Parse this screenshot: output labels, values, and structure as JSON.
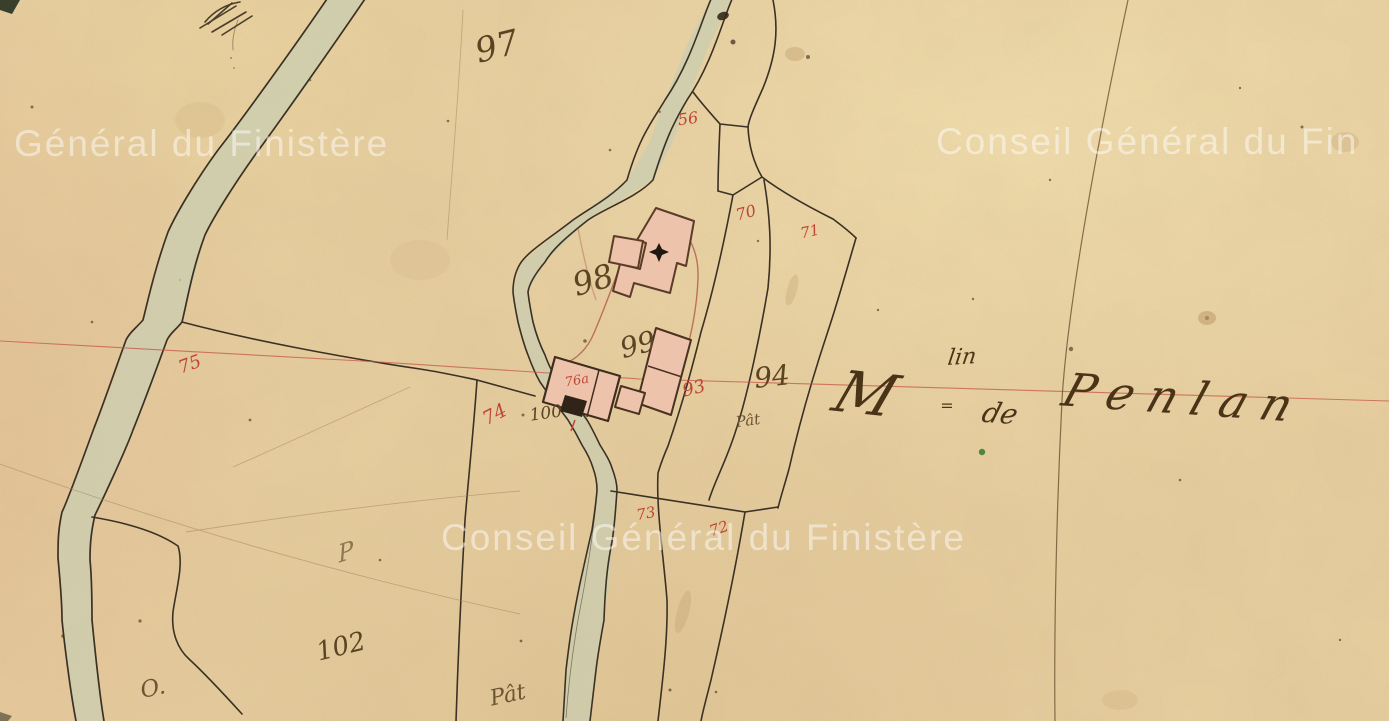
{
  "document_type": "Scanned 19th-century French cadastral map sheet (Finistère archives)",
  "place_name": {
    "abbreviation_initial": "M",
    "abbreviation_superscript": "lin",
    "abbreviation_underscore": "=",
    "connector": "de",
    "name": "Penlan",
    "reads_as": "Moulin de Penlan"
  },
  "watermarks": [
    {
      "text": "Général du Finistère"
    },
    {
      "text": "Conseil Général du Fin"
    },
    {
      "text": "Conseil Général du Finistère"
    }
  ],
  "parcel_numbers_black": [
    {
      "value": "97"
    },
    {
      "value": "98"
    },
    {
      "value": "99"
    },
    {
      "value": "100"
    },
    {
      "value": "102"
    },
    {
      "value": "94"
    }
  ],
  "parcel_numbers_red": [
    {
      "value": "75"
    },
    {
      "value": "74"
    },
    {
      "value": "76a"
    },
    {
      "value": "56"
    },
    {
      "value": "70"
    },
    {
      "value": "71"
    },
    {
      "value": "93"
    },
    {
      "value": "73"
    },
    {
      "value": "72"
    }
  ],
  "handwritten_notes": [
    {
      "text": "Pât"
    },
    {
      "text": "Pât"
    },
    {
      "text": "O."
    },
    {
      "text": "P"
    }
  ],
  "colors": {
    "paper": "#e8cfa0",
    "ink": "#3b3124",
    "red_ink": "#bf4535",
    "survey_red_line": "#c4574a",
    "road_fill": "#c9cdb1",
    "building_fill": "#eec3ab",
    "building_outline": "#5a3c28",
    "watermark": "rgba(255,255,255,0.48)",
    "toponym_ink": "#4a3417"
  }
}
